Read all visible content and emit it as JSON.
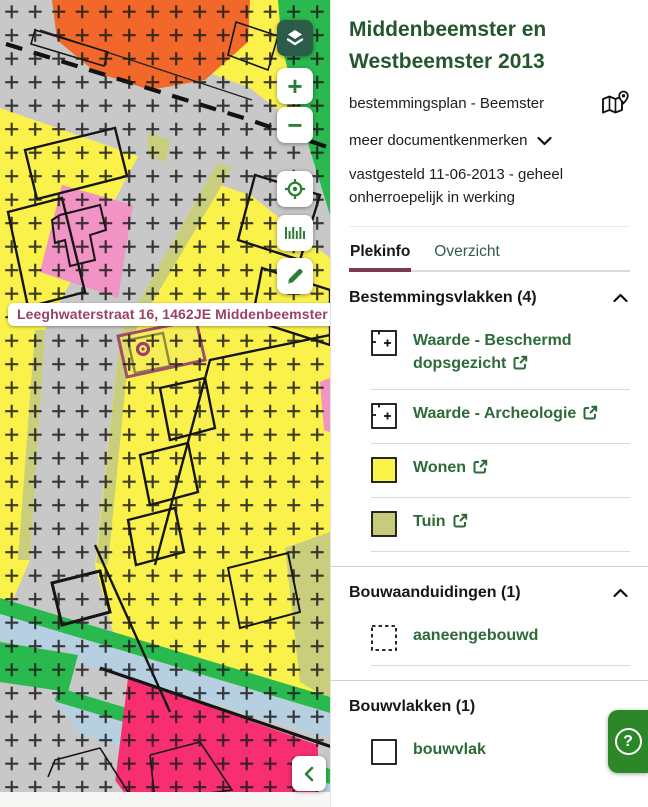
{
  "colors": {
    "brand_green": "#25562e",
    "link_green": "#2d6a38",
    "tab_active_underline": "#7d3a54",
    "tab_inactive": "#2f5d4c",
    "help_green": "#2b8727",
    "control_green": "#2c7d36",
    "layers_button_bg": "#2b5c49",
    "address_text": "#9b4169",
    "parcel_highlight": "#a04f6b",
    "map_yellow": "#faf14b",
    "map_gray": "#c8c8c8",
    "map_orange": "#f2682a",
    "map_green": "#29b94e",
    "map_pink": "#f193c4",
    "map_magenta": "#f72e6f",
    "map_blue": "#b7d0e1",
    "map_olive": "#c9ce7c",
    "swatch_yellow": "#fbf24b",
    "swatch_olive": "#c6cc7b"
  },
  "map": {
    "address_label": "Leeghwaterstraat 16, 1462JE Middenbeemster",
    "controls": {
      "zoom_in": "+",
      "zoom_out": "−",
      "icons": [
        "layers-icon",
        "zoom-in-icon",
        "zoom-out-icon",
        "locate-icon",
        "measure-icon",
        "pencil-icon",
        "chevron-left-icon"
      ]
    }
  },
  "panel": {
    "title": "Middenbeemster en Westbeemster 2013",
    "subtitle": "bestemmingsplan - Beemster",
    "map_pin_icon": "map-with-pin-icon",
    "more_link": "meer documentkenmerken",
    "status": "vastgesteld 11-06-2013 - geheel onherroepelijk in werking",
    "tabs": [
      {
        "label": "Plekinfo",
        "active": true
      },
      {
        "label": "Overzicht",
        "active": false
      }
    ],
    "sections": [
      {
        "title": "Bestemmingsvlakken (4)",
        "items": [
          {
            "label": "Waarde - Beschermd dopsgezicht",
            "swatch": "cross-pattern",
            "external": true
          },
          {
            "label": "Waarde - Archeologie",
            "swatch": "cross-pattern",
            "external": true
          },
          {
            "label": "Wonen",
            "swatch": "yellow-fill",
            "external": true
          },
          {
            "label": "Tuin",
            "swatch": "olive-fill",
            "external": true
          }
        ]
      },
      {
        "title": "Bouwaanduidingen (1)",
        "items": [
          {
            "label": "aaneengebouwd",
            "swatch": "dashed-outline",
            "external": false
          }
        ]
      },
      {
        "title": "Bouwvlakken (1)",
        "items": [
          {
            "label": "bouwvlak",
            "swatch": "solid-outline",
            "external": false
          }
        ]
      }
    ],
    "help_label": "?"
  }
}
